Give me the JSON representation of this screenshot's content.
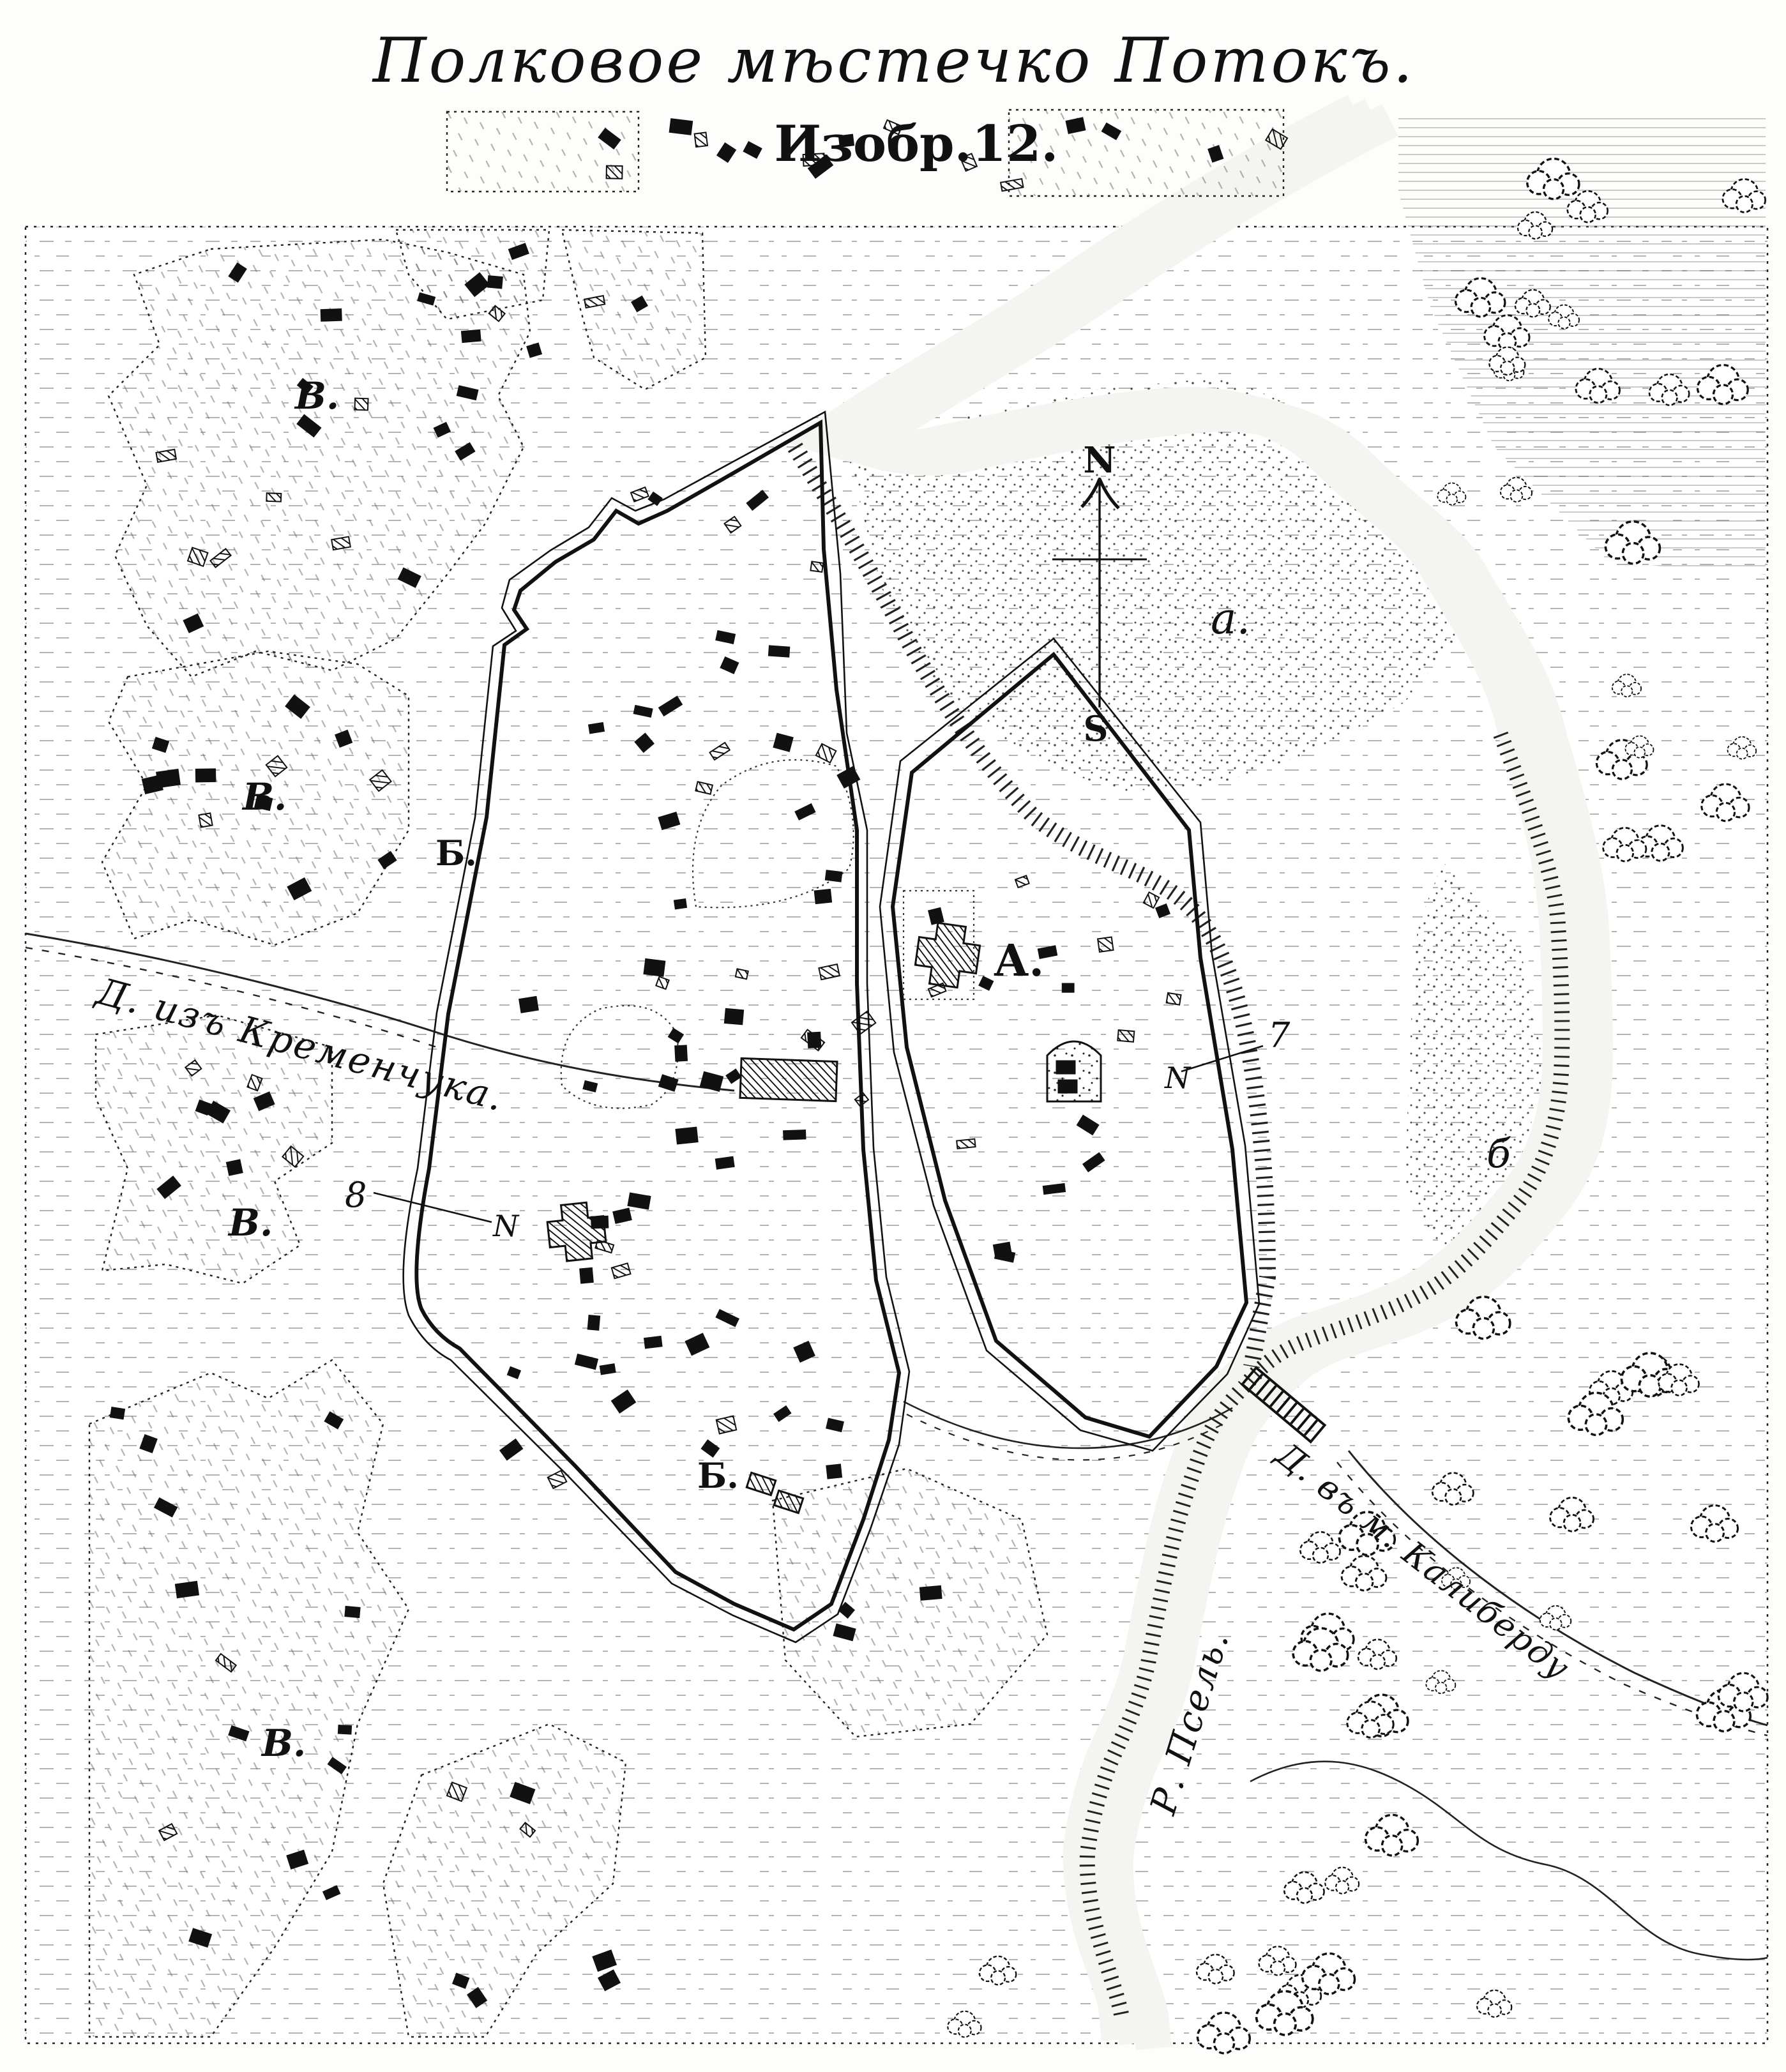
{
  "title": {
    "line1": "Полковое мѣстечко Потокъ.",
    "line2": "Изобр.12."
  },
  "compass": {
    "north": "N",
    "south": "S"
  },
  "labels": {
    "suburb_letter": "В.",
    "town_letter": "Б.",
    "citadel_letter": "А.",
    "meadow_letter": "а.",
    "bend_letter": "б",
    "ref7": "7",
    "ref8": "8",
    "ref_mark": "N",
    "road_kremenchuk": "Д. изъ Кременчука.",
    "road_kaliberda": "Д. въ м. Калиберду",
    "river": "Р. Псель."
  }
}
